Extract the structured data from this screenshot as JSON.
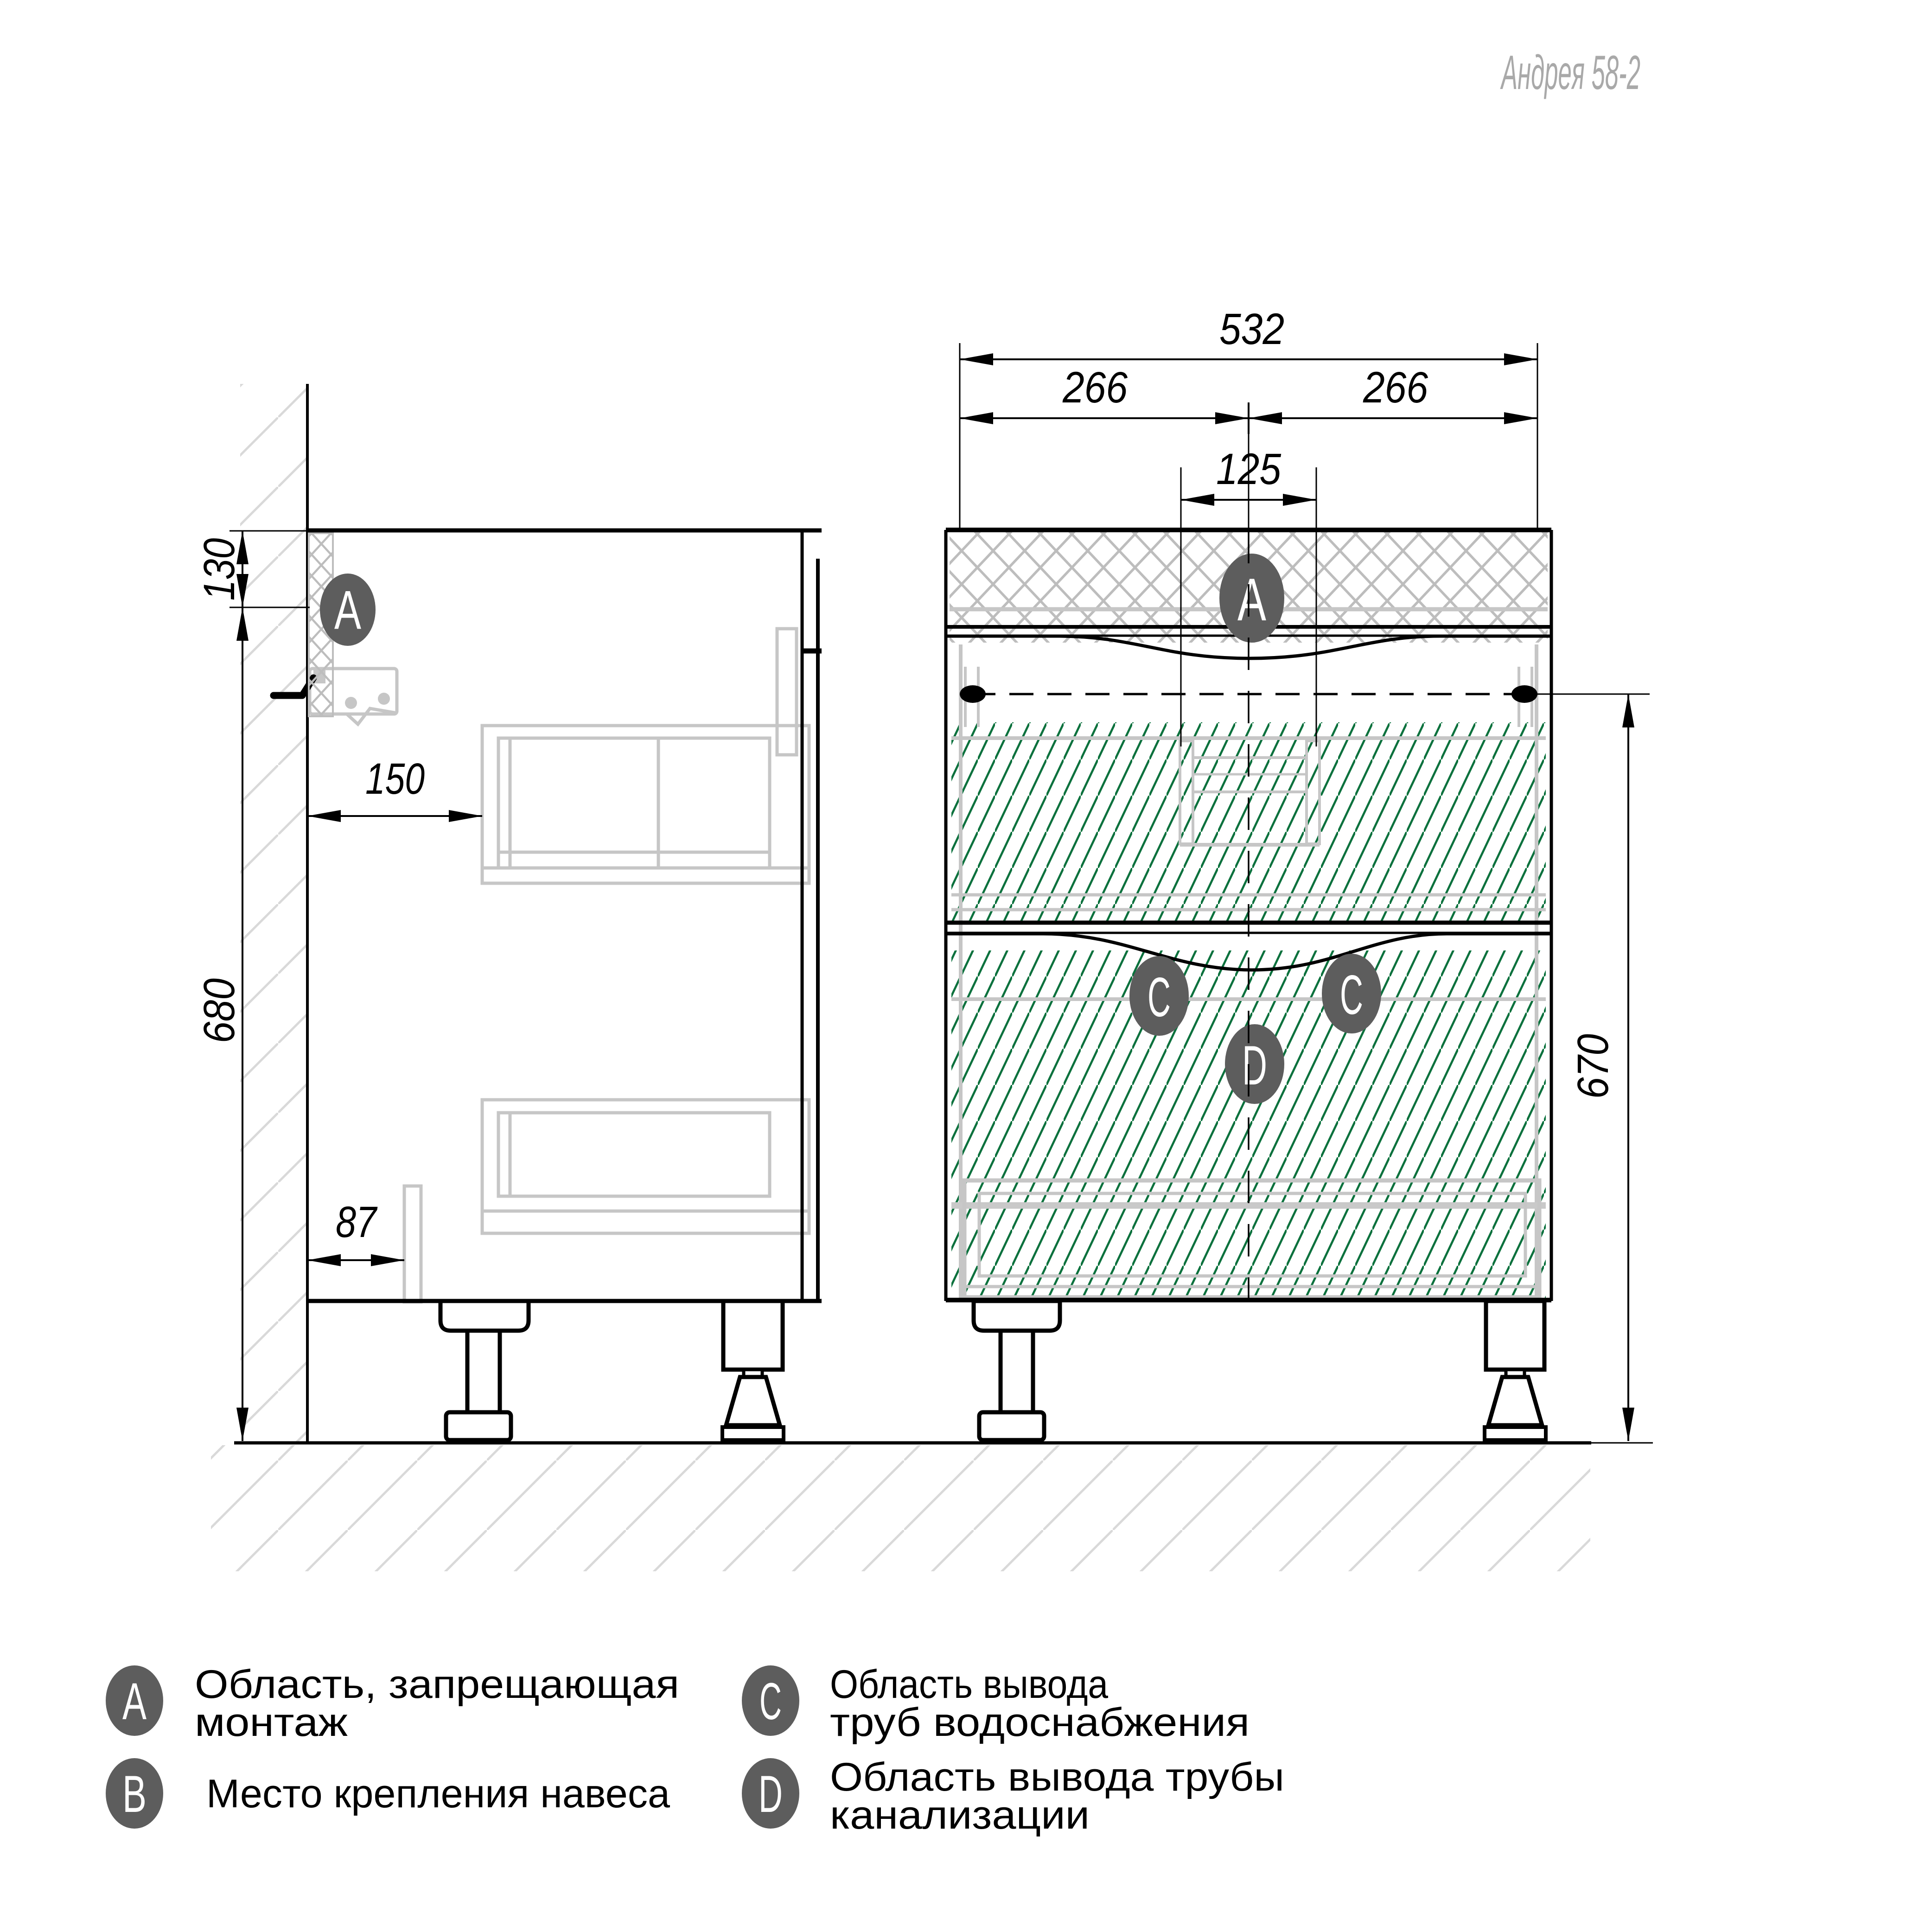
{
  "title": "Андрея 58-2",
  "dimensions": {
    "total_width": "532",
    "half_width_left": "266",
    "half_width_right": "266",
    "drain_zone_width": "125",
    "top_forbidden_height": "130",
    "hanger_height": "680",
    "hook_offset": "150",
    "bottom_offset": "87",
    "pipe_zone_height": "670"
  },
  "markers": {
    "a": "A",
    "b": "B",
    "c": "C",
    "d": "D"
  },
  "legend": [
    {
      "letter": "A",
      "line1": "Область, запрещающая",
      "line2": "монтаж"
    },
    {
      "letter": "B",
      "line1": "Место крепления навеса",
      "line2": ""
    },
    {
      "letter": "C",
      "line1": "Область вывода",
      "line2": "труб водоснабжения"
    },
    {
      "letter": "D",
      "line1": "Область вывода трубы",
      "line2": "канализации"
    }
  ],
  "colors": {
    "line_black": "#000000",
    "internal_gray": "#c6c6c6",
    "crosshatch_gray": "#bdbdbd",
    "wall_hatch_gray": "#d9d9d9",
    "green_hatch": "#0b713d",
    "marker_fill": "#5d5d5d",
    "title_gray": "#a9a9a9"
  }
}
